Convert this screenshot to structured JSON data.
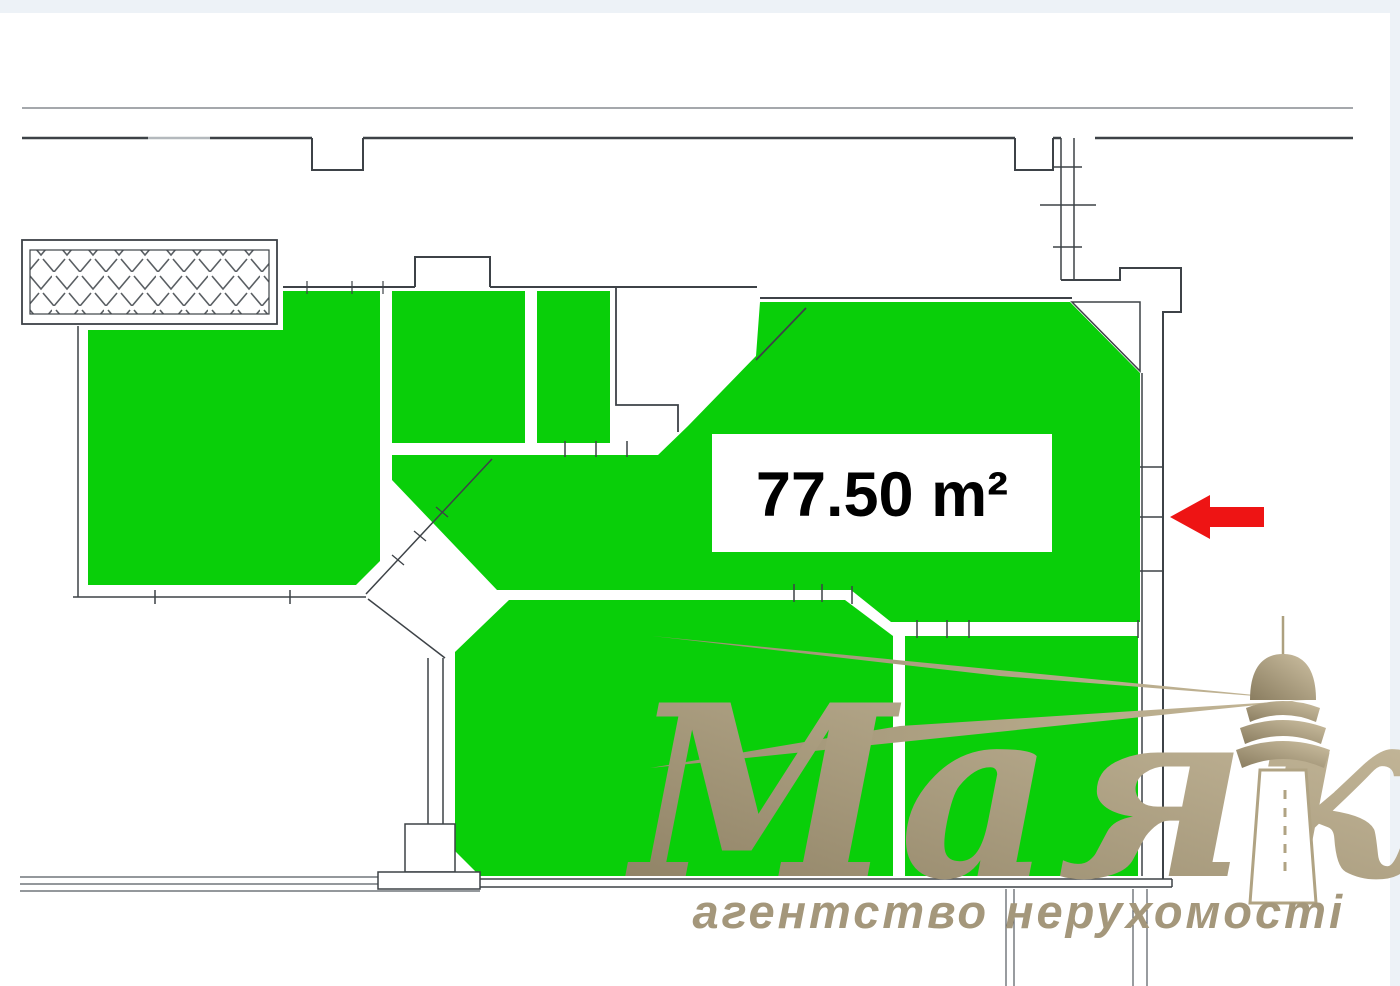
{
  "page": {
    "background": "#ffffff",
    "frame_color": "#edf2f7"
  },
  "floor_plan": {
    "area_label": {
      "text": "77.50 m²",
      "value": "77.50",
      "unit": "m²",
      "box_color": "#ffffff",
      "text_color": "#000000"
    },
    "highlight_color": "#09cf09",
    "wall_color": "#3d4247",
    "line_color": "#555b60",
    "balcony_hatch": "chevron-hatch",
    "entrance_arrow": {
      "icon": "left-arrow-icon",
      "color": "#ee1414",
      "direction": "left"
    }
  },
  "watermark": {
    "brand": "Маяк",
    "tagline": "агентство нерухомості",
    "color_start": "#8a7d60",
    "color_end": "#cdc0a2",
    "tagline_color": "#a4977b",
    "icon": "lighthouse-icon"
  }
}
